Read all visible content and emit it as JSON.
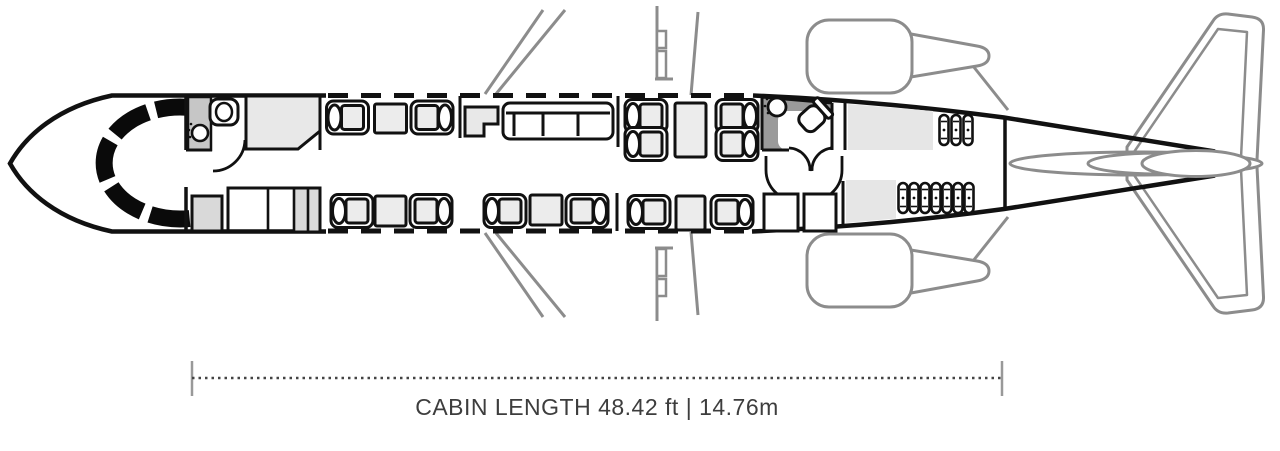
{
  "diagram": {
    "caption": "CABIN LENGTH 48.42 ft | 14.76m",
    "cabin_length": {
      "feet": "48.42 ft",
      "meters": "14.76m"
    },
    "colors": {
      "outline_black": "#111111",
      "airframe_gray": "#8c8c8c",
      "furniture_fill": "#ececec",
      "cabinet_fill": "#e8e8e8",
      "zone_fill": "#e6e6e6",
      "lavatory_wall_dark": "#9a9a9a",
      "lavatory_wall_light": "#c6c6c6",
      "text": "#3d3d3d"
    }
  }
}
